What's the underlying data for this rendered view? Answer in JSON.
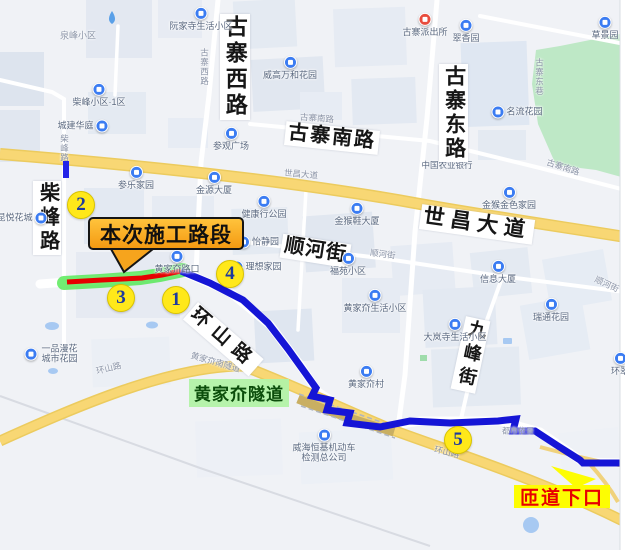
{
  "title_overlays": {
    "construction_section": "本次施工路段",
    "tunnel": "黄家夼隧道",
    "ramp_exit": "匝道下口"
  },
  "markers": [
    "1",
    "2",
    "3",
    "4",
    "5"
  ],
  "major_road_labels": {
    "chaifeng_road": "柴峰路",
    "guzhai_west_road": "古寨西路",
    "guzhai_south_road": "古寨南路",
    "guzhai_east_road": "古寨东路",
    "shichang_avenue": "世昌大道",
    "shunhe_street": "顺河街",
    "huanshan_road": "环山路",
    "jiufeng_street": "九峰街"
  },
  "street_tags": [
    "柴峰路",
    "古寨西路",
    "古寨南路",
    "世昌大道",
    "世昌大道",
    "顺河街",
    "顺河街",
    "古寨南路",
    "环山路",
    "环山路",
    "黄家夼南隧道",
    "古寨东巷"
  ],
  "pois": [
    {
      "label": "泉峰小区"
    },
    {
      "label": "阮家寺生活小区"
    },
    {
      "label": "古寨派出所"
    },
    {
      "label": "翠香园"
    },
    {
      "label": "草景园"
    },
    {
      "label": "威高万和花园"
    },
    {
      "label": "柴峰小区·1区"
    },
    {
      "label": "城建华庭"
    },
    {
      "label": "参观广场"
    },
    {
      "label": "名流花园"
    },
    {
      "label": "参乐家园"
    },
    {
      "label": "金源大厦"
    },
    {
      "label": "健康行公园"
    },
    {
      "label": "中国农业银行"
    },
    {
      "label": "金猴鞋大厦"
    },
    {
      "label": "金猴金色家园"
    },
    {
      "label": "昆悦花城"
    },
    {
      "label": "怡静园"
    },
    {
      "label": "理想家园"
    },
    {
      "label": "福苑小区"
    },
    {
      "label": "信息大厦"
    },
    {
      "label": "黄家夼生活小区"
    },
    {
      "label": "瑞通花园"
    },
    {
      "label": "大岚寺生活小区"
    },
    {
      "label": "环翠"
    },
    {
      "label": "黄家夼村"
    },
    {
      "label": "黄家夼路口"
    },
    {
      "label": "一品漫花城市花园"
    },
    {
      "label": "威海恒基机动车检测总公司"
    },
    {
      "label": "都市依景"
    }
  ],
  "colors": {
    "route_blue": "#1515d6",
    "construction_red": "#e60000",
    "construction_glow": "#4fe84f",
    "marker_yellow": "#ffe81a",
    "callout_orange": "#f6a41d",
    "ramp_yellow": "#fdfd02",
    "tunnel_label_green": "#b2f2a6",
    "main_road_yellow": "#f6d169",
    "park_green": "#bee8c6"
  }
}
